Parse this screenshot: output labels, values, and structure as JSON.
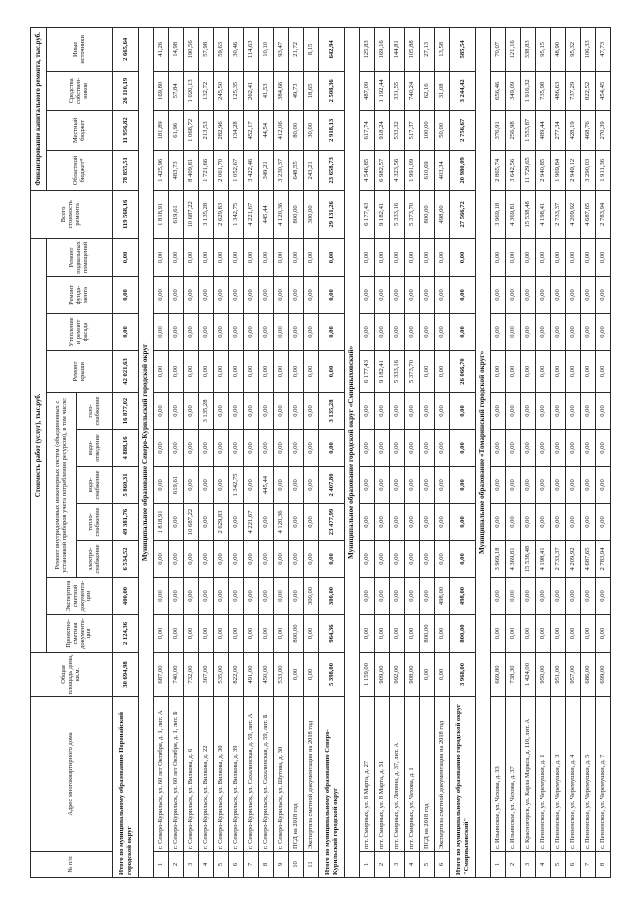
{
  "table": {
    "headers": {
      "num": "№ п/п",
      "address": "Адрес многоквартирного дома",
      "area": "Общая площадь дома, кв.м.",
      "cost_group": "Стоимость работ (услуг), тыс.руб.",
      "psd": "Проектно-сметная документа-ция",
      "exp": "Экспертиза сметной документа-ции",
      "eng_group": "Ремонт внутридомовых инженерных систем (объединенных с установкой приборов учета потребления ресурсов), в том числе:",
      "el": "электро-снабжение",
      "heat": "тепло-снабжение",
      "wsup": "водо-снабжение",
      "wdis": "водо-отведение",
      "gas": "газо-снабжение",
      "roof": "Ремонт крыши",
      "fac": "Утепление и ремонт фасада",
      "fnd": "Ремонт фунда-мента",
      "bas": "Ремонт подвальных помещений",
      "tot": "Всего стоимость ремонта",
      "fin_group": "Финансирование капитального ремонта, тыс.руб.",
      "obl": "Областной бюджет*",
      "loc": "Местный бюджет",
      "own": "Средства собствен-ников",
      "oth": "Иные источники"
    },
    "rows": [
      {
        "kind": "totals",
        "label": "Итого по муниципальному образованию Поронайский городской округ",
        "v": [
          "30 694,98",
          "2 124,36",
          "400,00",
          "6 534,52",
          "49 381,76",
          "5 860,31",
          "4 888,16",
          "16 877,02",
          "42 021,63",
          "0,00",
          "0,00",
          "0,00",
          "119 568,16",
          "78 855,51",
          "11 956,82",
          "26 110,19",
          "2 665,64"
        ]
      },
      {
        "kind": "section",
        "label": "Муниципальное образование Северо-Курильский городской округ"
      },
      {
        "kind": "data",
        "num": "1",
        "label": "г. Северо-Курильск, ул. 60 лет Октября, д. 1, лит. А",
        "v": [
          "687,00",
          "0,00",
          "0,00",
          "0,00",
          "1 818,91",
          "0,00",
          "0,00",
          "0,00",
          "0,00",
          "0,00",
          "0,00",
          "0,00",
          "1 818,91",
          "1 425,96",
          "181,89",
          "169,80",
          "41,26"
        ]
      },
      {
        "kind": "data",
        "num": "2",
        "label": "г. Северо-Курильск, ул. 60 лет Октября, д. 1, лит. Б",
        "v": [
          "740,00",
          "0,00",
          "0,00",
          "0,00",
          "0,00",
          "619,61",
          "0,00",
          "0,00",
          "0,00",
          "0,00",
          "0,00",
          "0,00",
          "619,61",
          "483,73",
          "61,96",
          "57,84",
          "14,98"
        ]
      },
      {
        "kind": "data",
        "num": "3",
        "label": "г. Северо-Курильск, ул. Вилкова, д. 6",
        "v": [
          "732,00",
          "0,00",
          "0,00",
          "0,00",
          "10 687,22",
          "0,00",
          "0,00",
          "0,00",
          "0,00",
          "0,00",
          "0,00",
          "0,00",
          "10 687,22",
          "8 409,81",
          "1 068,72",
          "1 020,13",
          "190,56"
        ]
      },
      {
        "kind": "data",
        "num": "4",
        "label": "г. Северо-Курильск, ул. Вилкова, д. 22",
        "v": [
          "367,00",
          "0,00",
          "0,00",
          "0,00",
          "0,00",
          "0,00",
          "0,00",
          "3 135,28",
          "0,00",
          "0,00",
          "0,00",
          "0,00",
          "3 135,28",
          "1 721,66",
          "213,53",
          "132,72",
          "57,98"
        ]
      },
      {
        "kind": "data",
        "num": "5",
        "label": "г. Северо-Курильск, ул. Вилкова, д. 30",
        "v": [
          "535,00",
          "0,00",
          "0,00",
          "0,00",
          "2 629,83",
          "0,00",
          "0,00",
          "0,00",
          "0,00",
          "0,00",
          "0,00",
          "0,00",
          "2 629,83",
          "2 061,70",
          "282,96",
          "245,50",
          "59,63"
        ]
      },
      {
        "kind": "data",
        "num": "6",
        "label": "г. Северо-Курильск, ул. Вилкова, д. 39",
        "v": [
          "822,00",
          "0,00",
          "0,00",
          "0,00",
          "0,00",
          "1 342,75",
          "0,00",
          "0,00",
          "0,00",
          "0,00",
          "0,00",
          "0,00",
          "1 342,75",
          "1 052,67",
          "134,28",
          "125,35",
          "30,46"
        ]
      },
      {
        "kind": "data",
        "num": "7",
        "label": "г. Северо-Курильск, ул. Сахалинская, д. 59, лит. А",
        "v": [
          "491,00",
          "0,00",
          "0,00",
          "0,00",
          "4 221,67",
          "0,00",
          "0,00",
          "0,00",
          "0,00",
          "0,00",
          "0,00",
          "0,00",
          "4 221,67",
          "3 422,46",
          "452,17",
          "262,41",
          "114,63"
        ]
      },
      {
        "kind": "data",
        "num": "8",
        "label": "г. Северо-Курильск, ул. Сахалинская, д. 59, лит. Б",
        "v": [
          "450,00",
          "0,00",
          "0,00",
          "0,00",
          "0,00",
          "445,44",
          "0,00",
          "0,00",
          "0,00",
          "0,00",
          "0,00",
          "0,00",
          "445,44",
          "349,21",
          "44,54",
          "41,53",
          "10,10"
        ]
      },
      {
        "kind": "data",
        "num": "9",
        "label": "г. Северо-Курильск, ул. Шутова, д. 30",
        "v": [
          "533,00",
          "0,00",
          "0,00",
          "0,00",
          "4 120,36",
          "0,00",
          "0,00",
          "0,00",
          "0,00",
          "0,00",
          "0,00",
          "0,00",
          "4 120,36",
          "3 230,37",
          "412,06",
          "384,66",
          "93,47"
        ]
      },
      {
        "kind": "data",
        "num": "10",
        "label": "ПСД на 2018 год",
        "v": [
          "0,00",
          "800,00",
          "0,00",
          "0,00",
          "0,00",
          "0,00",
          "0,00",
          "0,00",
          "0,00",
          "0,00",
          "0,00",
          "0,00",
          "800,00",
          "648,55",
          "80,00",
          "49,73",
          "21,72"
        ]
      },
      {
        "kind": "data",
        "num": "11",
        "label": "Экспертиза сметной документации на 2018 год",
        "v": [
          "0,00",
          "0,00",
          "300,00",
          "0,00",
          "0,00",
          "0,00",
          "0,00",
          "0,00",
          "0,00",
          "0,00",
          "0,00",
          "0,00",
          "300,00",
          "243,21",
          "30,00",
          "18,65",
          "8,15"
        ]
      },
      {
        "kind": "totals",
        "label": "Итого по муниципальному образованию Северо-Курильский городской округ",
        "v": [
          "5 398,00",
          "964,36",
          "300,00",
          "0,00",
          "23 477,99",
          "2 407,80",
          "0,00",
          "3 135,28",
          "0,00",
          "0,00",
          "0,00",
          "0,00",
          "29 131,26",
          "23 658,73",
          "2 918,13",
          "2 508,36",
          "642,94"
        ]
      },
      {
        "kind": "section",
        "label": "Муниципальное образование городской округ «Смирныховский»"
      },
      {
        "kind": "data",
        "num": "1",
        "label": "пгт. Смирных, ул. 8 Марта, д. 27",
        "v": [
          "1 159,00",
          "0,00",
          "0,00",
          "0,00",
          "0,00",
          "0,00",
          "0,00",
          "0,00",
          "6 177,43",
          "0,00",
          "0,00",
          "0,00",
          "6 177,43",
          "4 546,85",
          "617,74",
          "487,09",
          "125,83"
        ]
      },
      {
        "kind": "data",
        "num": "2",
        "label": "пгт. Смирных, ул. 8 Марта, д. 31",
        "v": [
          "909,00",
          "0,00",
          "0,00",
          "0,00",
          "0,00",
          "0,00",
          "0,00",
          "0,00",
          "9 182,41",
          "0,00",
          "0,00",
          "0,00",
          "9 182,41",
          "6 982,57",
          "918,24",
          "1 192,44",
          "169,16"
        ]
      },
      {
        "kind": "data",
        "num": "3",
        "label": "пгт. Смирных, ул. Ленина, д. 37, лит. А",
        "v": [
          "992,00",
          "0,00",
          "0,00",
          "0,00",
          "0,00",
          "0,00",
          "0,00",
          "0,00",
          "5 333,16",
          "0,00",
          "0,00",
          "0,00",
          "5 333,16",
          "4 323,56",
          "533,32",
          "331,55",
          "144,81"
        ]
      },
      {
        "kind": "data",
        "num": "4",
        "label": "пгт. Смирных, ул. Чехова, д. 1",
        "v": [
          "908,00",
          "0,00",
          "0,00",
          "0,00",
          "0,00",
          "0,00",
          "0,00",
          "0,00",
          "5 373,70",
          "0,00",
          "0,00",
          "0,00",
          "5 373,70",
          "1 991,09",
          "517,37",
          "740,24",
          "105,88"
        ]
      },
      {
        "kind": "data",
        "num": "5",
        "label": "ПСД на 2018 год",
        "v": [
          "0,00",
          "800,00",
          "0,00",
          "0,00",
          "0,00",
          "0,00",
          "0,00",
          "0,00",
          "0,00",
          "0,00",
          "0,00",
          "0,00",
          "800,00",
          "610,69",
          "100,00",
          "62,16",
          "27,13"
        ]
      },
      {
        "kind": "data",
        "num": "6",
        "label": "Экспертиза сметной документации на 2018 год",
        "v": [
          "0,00",
          "0,00",
          "498,00",
          "0,00",
          "0,00",
          "0,00",
          "0,00",
          "0,00",
          "0,00",
          "0,00",
          "0,00",
          "0,00",
          "498,00",
          "403,34",
          "50,00",
          "31,08",
          "13,58"
        ]
      },
      {
        "kind": "totals",
        "label": "Итого по муниципальному образованию городской округ \"Смирныховский\"",
        "v": [
          "3 968,00",
          "800,00",
          "498,00",
          "0,00",
          "0,00",
          "0,00",
          "0,00",
          "0,00",
          "26 066,70",
          "0,00",
          "0,00",
          "0,00",
          "27 566,72",
          "20 980,09",
          "2 756,67",
          "3 244,42",
          "585,54"
        ]
      },
      {
        "kind": "section",
        "label": "Муниципальное образование «Томаринский городской округ»"
      },
      {
        "kind": "data",
        "num": "1",
        "label": "с. Ильинское, ул. Чехова, д. 33",
        "v": [
          "669,80",
          "0,00",
          "0,00",
          "3 969,18",
          "0,00",
          "0,00",
          "0,00",
          "0,00",
          "0,00",
          "0,00",
          "0,00",
          "0,00",
          "3 969,18",
          "2 865,74",
          "376,91",
          "656,46",
          "70,07"
        ]
      },
      {
        "kind": "data",
        "num": "2",
        "label": "с. Ильинское, ул. Чехова, д. 37",
        "v": [
          "738,30",
          "0,00",
          "0,00",
          "4 369,81",
          "0,00",
          "0,00",
          "0,00",
          "0,00",
          "0,00",
          "0,00",
          "0,00",
          "0,00",
          "4 369,81",
          "3 642,56",
          "256,98",
          "349,09",
          "121,16"
        ]
      },
      {
        "kind": "data",
        "num": "3",
        "label": "с. Красногорск, ул. Карла Маркса, д. 116, лит. А",
        "v": [
          "1 424,00",
          "0,00",
          "0,00",
          "15 538,48",
          "0,00",
          "0,00",
          "0,00",
          "0,00",
          "0,00",
          "0,00",
          "0,00",
          "0,00",
          "15 538,48",
          "11 729,65",
          "1 553,87",
          "1 916,32",
          "338,83"
        ]
      },
      {
        "kind": "data",
        "num": "4",
        "label": "с. Пензенское, ул. Черемушки, д. 1",
        "v": [
          "950,00",
          "0,00",
          "0,00",
          "4 198,41",
          "0,00",
          "0,00",
          "0,00",
          "0,00",
          "0,00",
          "0,00",
          "0,00",
          "0,00",
          "4 198,41",
          "2 940,85",
          "489,44",
          "735,98",
          "95,15"
        ]
      },
      {
        "kind": "data",
        "num": "5",
        "label": "с. Пензенское, ул. Черемушки, д. 3",
        "v": [
          "951,00",
          "0,00",
          "0,00",
          "2 733,37",
          "0,00",
          "0,00",
          "0,00",
          "0,00",
          "0,00",
          "0,00",
          "0,00",
          "0,00",
          "2 733,37",
          "1 969,84",
          "277,34",
          "486,63",
          "48,90"
        ]
      },
      {
        "kind": "data",
        "num": "6",
        "label": "с. Пензенское, ул. Черемушки, д. 4",
        "v": [
          "957,00",
          "0,00",
          "0,00",
          "4 209,92",
          "0,00",
          "0,00",
          "0,00",
          "0,00",
          "0,00",
          "0,00",
          "0,00",
          "0,00",
          "4 209,92",
          "2 949,12",
          "428,19",
          "737,29",
          "95,32"
        ]
      },
      {
        "kind": "data",
        "num": "7",
        "label": "с. Пензенское, ул. Черемушки, д. 5",
        "v": [
          "686,00",
          "0,00",
          "0,00",
          "4 687,65",
          "0,00",
          "0,00",
          "0,00",
          "0,00",
          "0,00",
          "0,00",
          "0,00",
          "0,00",
          "4 687,65",
          "3 290,03",
          "468,76",
          "822,52",
          "106,33"
        ]
      },
      {
        "kind": "data",
        "num": "8",
        "label": "с. Пензенское, ул. Черемушки, д. 7",
        "v": [
          "699,00",
          "0,00",
          "0,00",
          "2 783,94",
          "0,00",
          "0,00",
          "0,00",
          "0,00",
          "0,00",
          "0,00",
          "0,00",
          "0,00",
          "2 783,94",
          "1 911,36",
          "270,39",
          "454,45",
          "47,73"
        ]
      }
    ]
  }
}
